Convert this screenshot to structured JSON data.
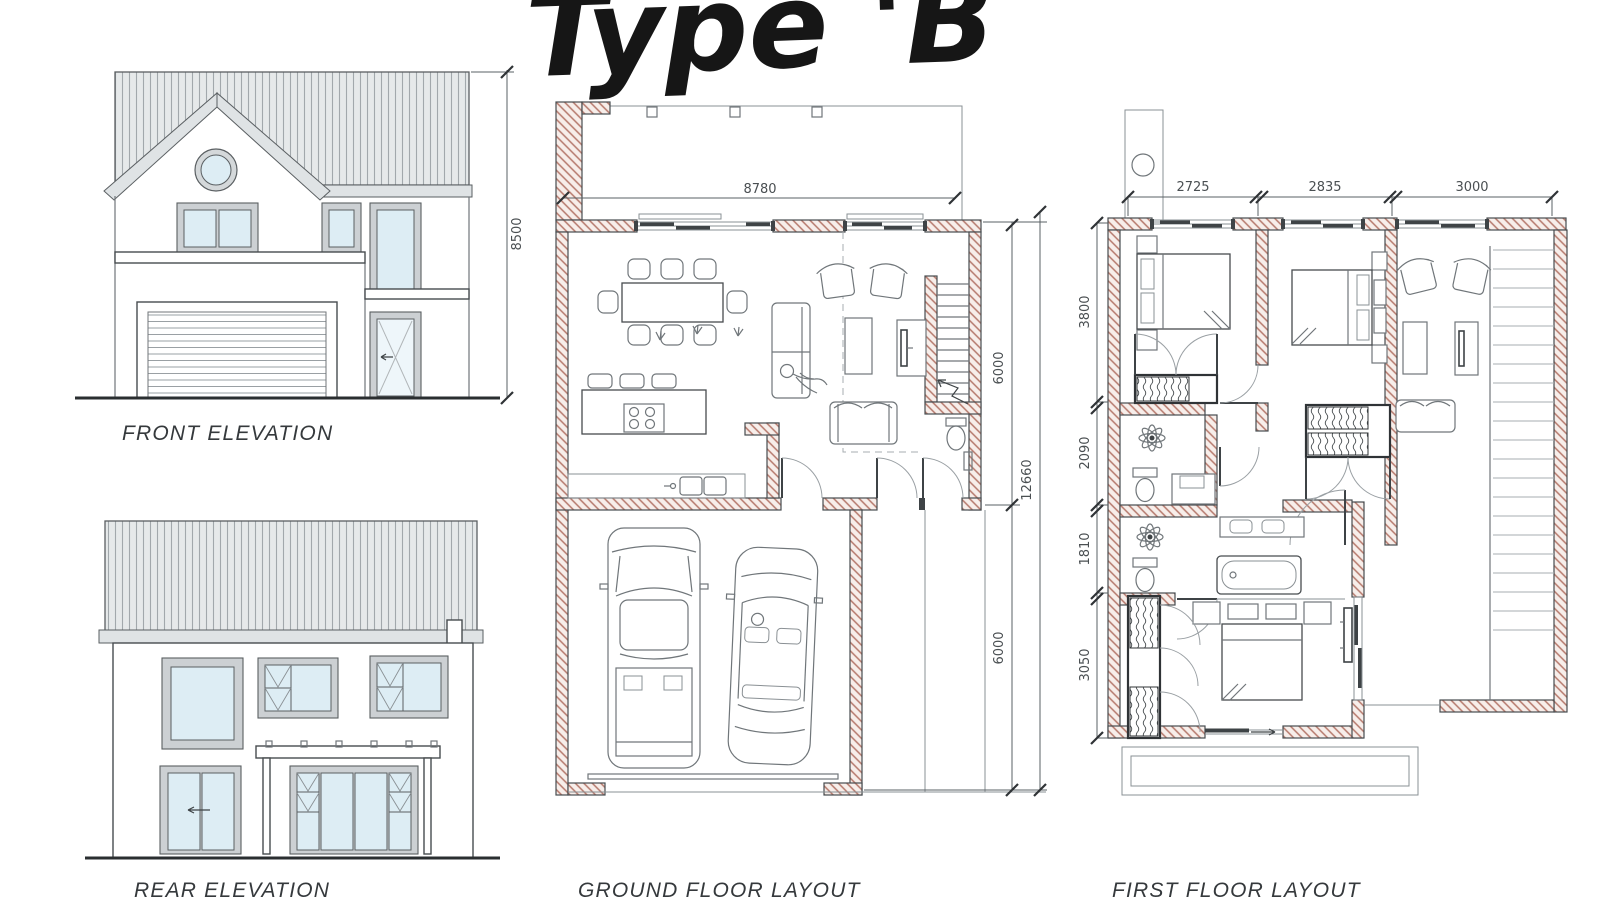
{
  "title": "Type 'B",
  "colors": {
    "wall_hatch": "#b5786b",
    "wall_fill": "#f7eeea",
    "glass": "#ddedf4",
    "roof_fill": "#e6e9ea",
    "frame_gray": "#ccd0d3",
    "line_dark": "#3e4346",
    "dim_text": "#4a4f52"
  },
  "panels": {
    "front_elevation": {
      "label": "FRONT ELEVATION",
      "dims": {
        "height": "8500"
      }
    },
    "rear_elevation": {
      "label": "REAR ELEVATION"
    },
    "ground_floor": {
      "label": "GROUND FLOOR LAYOUT",
      "dims": {
        "width": "8780",
        "living_depth": "6000",
        "garage_depth": "6000",
        "total_depth": "12660"
      }
    },
    "first_floor": {
      "label": "FIRST FLOOR LAYOUT",
      "dims": {
        "top": [
          "2725",
          "2835",
          "3000"
        ],
        "left": [
          "3800",
          "2090",
          "1810",
          "3050"
        ]
      }
    }
  }
}
